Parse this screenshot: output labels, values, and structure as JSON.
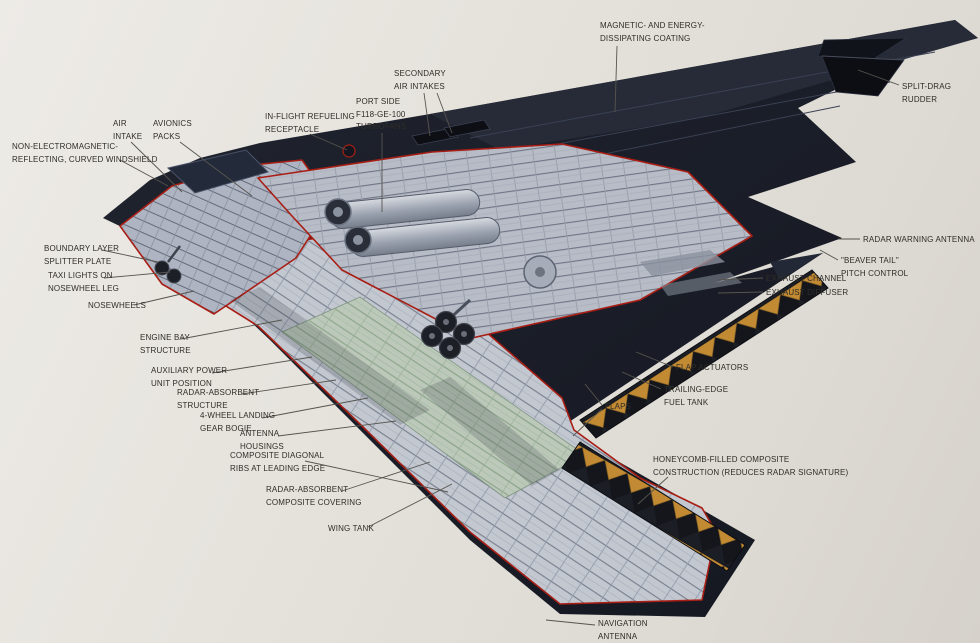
{
  "figure": {
    "subject": "B-2 stealth bomber cutaway diagram",
    "colors": {
      "background": "#e6e3dd",
      "airframe_dark": "#171a23",
      "airframe_sheen": "#262b37",
      "cutaway_gray": "#c2c7d0",
      "cutaway_body_gray": "#b7bcc7",
      "wing_deck_green": "#bccab9",
      "honeycomb_orange": "#c18a33",
      "cutaway_outline_red": "#a81e14",
      "label_text": "#2f2d28",
      "leader_line": "#56544e"
    }
  },
  "callouts": [
    {
      "id": "magnetic-coating",
      "text": "MAGNETIC- AND ENERGY-\nDISSIPATING COATING",
      "x": 600,
      "y": 20,
      "leaders": [
        [
          617,
          46,
          615,
          112
        ]
      ]
    },
    {
      "id": "split-drag-rudder",
      "text": "SPLIT-DRAG RUDDER",
      "x": 902,
      "y": 81,
      "leaders": [
        [
          899,
          85,
          858,
          70
        ]
      ]
    },
    {
      "id": "secondary-air-intakes",
      "text": "SECONDARY\nAIR INTAKES",
      "x": 394,
      "y": 68,
      "leaders": [
        [
          424,
          93,
          430,
          136
        ],
        [
          437,
          93,
          452,
          133
        ]
      ]
    },
    {
      "id": "port-side-turbofans",
      "text": "PORT SIDE\nF118-GE-100\nTURBOFANS",
      "x": 356,
      "y": 96,
      "leaders": [
        [
          382,
          133,
          382,
          212
        ]
      ]
    },
    {
      "id": "in-flight-refueling",
      "text": "IN-FLIGHT REFUELING\nRECEPTACLE",
      "x": 265,
      "y": 111,
      "leaders": [
        [
          310,
          134,
          347,
          150
        ]
      ]
    },
    {
      "id": "air-intake",
      "text": "AIR\nINTAKE",
      "x": 113,
      "y": 118,
      "leaders": [
        [
          131,
          142,
          182,
          192
        ]
      ]
    },
    {
      "id": "avionics-packs",
      "text": "AVIONICS\nPACKS",
      "x": 153,
      "y": 118,
      "leaders": [
        [
          180,
          142,
          252,
          196
        ]
      ]
    },
    {
      "id": "windshield",
      "text": "NON-ELECTROMAGNETIC-\nREFLECTING, CURVED WINDSHIELD",
      "x": 12,
      "y": 141,
      "leaders": [
        [
          120,
          160,
          168,
          186
        ]
      ]
    },
    {
      "id": "boundary-layer",
      "text": "BOUNDARY LAYER\nSPLITTER PLATE",
      "x": 44,
      "y": 243,
      "leaders": [
        [
          102,
          250,
          158,
          262
        ]
      ]
    },
    {
      "id": "taxi-lights",
      "text": "TAXI LIGHTS ON\nNOSEWHEEL LEG",
      "x": 48,
      "y": 270,
      "leaders": [
        [
          104,
          278,
          170,
          272
        ]
      ]
    },
    {
      "id": "nosewheels",
      "text": "NOSEWHEELS",
      "x": 88,
      "y": 300,
      "leaders": [
        [
          134,
          305,
          194,
          291
        ]
      ]
    },
    {
      "id": "engine-bay",
      "text": "ENGINE BAY\nSTRUCTURE",
      "x": 140,
      "y": 332,
      "leaders": [
        [
          181,
          339,
          282,
          320
        ]
      ]
    },
    {
      "id": "apu",
      "text": "AUXILIARY POWER\nUNIT POSITION",
      "x": 151,
      "y": 365,
      "leaders": [
        [
          212,
          373,
          312,
          357
        ]
      ]
    },
    {
      "id": "radar-absorbent-structure",
      "text": "RADAR-ABSORBENT\nSTRUCTURE",
      "x": 177,
      "y": 387,
      "leaders": [
        [
          242,
          394,
          336,
          380
        ]
      ]
    },
    {
      "id": "landing-gear-bogie",
      "text": "4-WHEEL LANDING\nGEAR BOGIE",
      "x": 200,
      "y": 410,
      "leaders": [
        [
          262,
          418,
          368,
          398
        ]
      ]
    },
    {
      "id": "antenna-housings",
      "text": "ANTENNA\nHOUSINGS",
      "x": 240,
      "y": 428,
      "leaders": [
        [
          278,
          436,
          396,
          421
        ]
      ]
    },
    {
      "id": "composite-ribs",
      "text": "COMPOSITE DIAGONAL\nRIBS AT LEADING EDGE",
      "x": 230,
      "y": 450,
      "leaders": [
        [
          305,
          461,
          448,
          492
        ]
      ]
    },
    {
      "id": "rac-covering",
      "text": "RADAR-ABSORBENT\nCOMPOSITE COVERING",
      "x": 266,
      "y": 484,
      "leaders": [
        [
          342,
          491,
          430,
          462
        ]
      ]
    },
    {
      "id": "wing-tank",
      "text": "WING TANK",
      "x": 328,
      "y": 523,
      "leaders": [
        [
          368,
          527,
          452,
          484
        ]
      ]
    },
    {
      "id": "radar-warning-antenna",
      "text": "RADAR WARNING ANTENNA",
      "x": 863,
      "y": 234,
      "leaders": [
        [
          860,
          239,
          838,
          239
        ]
      ]
    },
    {
      "id": "beaver-tail",
      "text": "\"BEAVER TAIL\"\nPITCH CONTROL",
      "x": 841,
      "y": 255,
      "leaders": [
        [
          838,
          260,
          820,
          250
        ]
      ]
    },
    {
      "id": "exhaust-channel",
      "text": "EXHAUST CHANNEL",
      "x": 766,
      "y": 273,
      "leaders": [
        [
          763,
          278,
          718,
          280
        ]
      ]
    },
    {
      "id": "exhaust-diffuser",
      "text": "EXHAUST DIFFUSER",
      "x": 766,
      "y": 287,
      "leaders": [
        [
          763,
          292,
          718,
          293
        ]
      ]
    },
    {
      "id": "flap-actuators",
      "text": "FLAP ACTUATORS",
      "x": 676,
      "y": 362,
      "leaders": [
        [
          673,
          367,
          636,
          352
        ]
      ]
    },
    {
      "id": "trailing-edge-tank",
      "text": "TRAILING-EDGE\nFUEL TANK",
      "x": 664,
      "y": 384,
      "leaders": [
        [
          661,
          389,
          622,
          372
        ]
      ]
    },
    {
      "id": "flaps",
      "text": "FLAPS",
      "x": 605,
      "y": 401,
      "leaders": [
        [
          602,
          405,
          585,
          384
        ],
        [
          602,
          409,
          573,
          436
        ]
      ]
    },
    {
      "id": "honeycomb",
      "text": "HONEYCOMB-FILLED COMPOSITE\nCONSTRUCTION (REDUCES RADAR SIGNATURE)",
      "x": 653,
      "y": 454,
      "leaders": [
        [
          668,
          477,
          638,
          504
        ]
      ]
    },
    {
      "id": "navigation-antenna",
      "text": "NAVIGATION\nANTENNA",
      "x": 598,
      "y": 618,
      "leaders": [
        [
          595,
          625,
          546,
          620
        ]
      ]
    }
  ]
}
